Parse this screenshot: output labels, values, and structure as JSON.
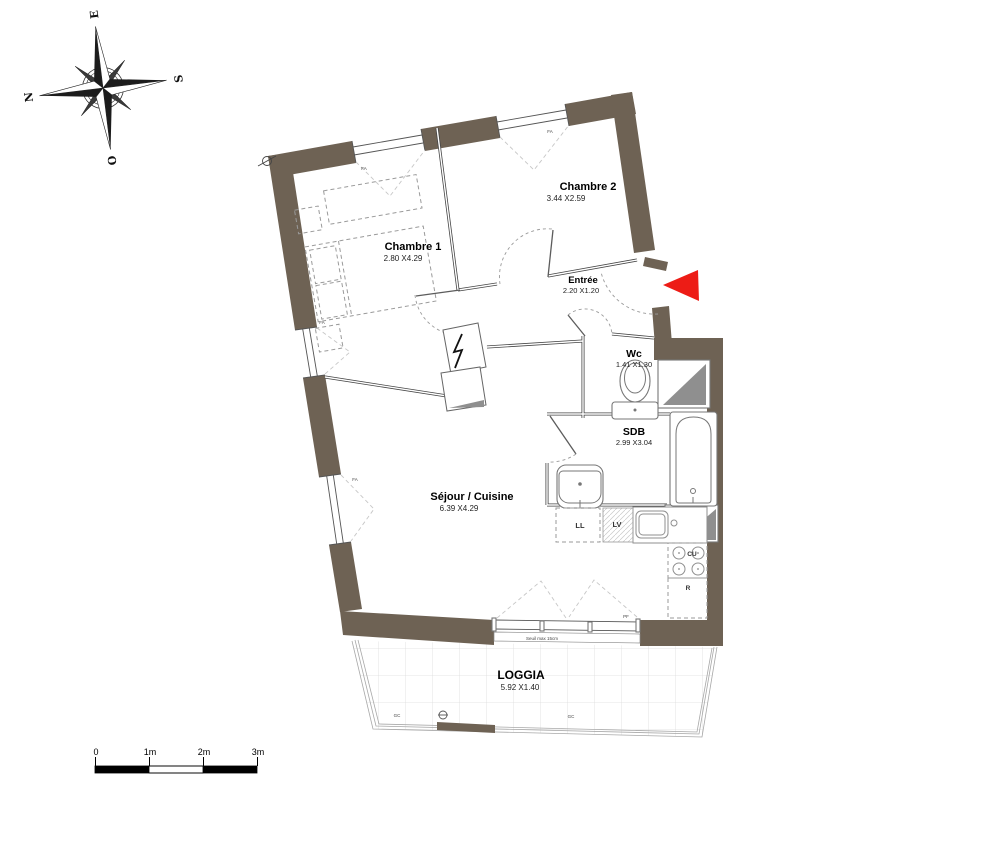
{
  "compass": {
    "n": "N",
    "e": "E",
    "s": "S",
    "o": "O"
  },
  "colors": {
    "wall": "#6e6254",
    "arrow": "#ed1c16"
  },
  "rooms": {
    "chambre1": {
      "name": "Chambre 1",
      "dims": "2.80 X4.29"
    },
    "chambre2": {
      "name": "Chambre 2",
      "dims": "3.44 X2.59"
    },
    "entree": {
      "name": "Entrée",
      "dims": "2.20 X1.20"
    },
    "wc": {
      "name": "Wc",
      "dims": "1.41 X1.30"
    },
    "sdb": {
      "name": "SDB",
      "dims": "2.99 X3.04"
    },
    "sejour": {
      "name": "Séjour / Cuisine",
      "dims": "6.39 X4.29"
    },
    "loggia": {
      "name": "LOGGIA",
      "dims": "5.92 X1.40"
    }
  },
  "labels": {
    "ll": "LL",
    "lv": "LV",
    "cu": "CU",
    "r": "R",
    "pf": "PF",
    "gc": "GC",
    "fa": "FA",
    "seuil": "Seuil max 15cm"
  },
  "scale": {
    "ticks": [
      "0",
      "1m",
      "2m",
      "3m"
    ]
  }
}
